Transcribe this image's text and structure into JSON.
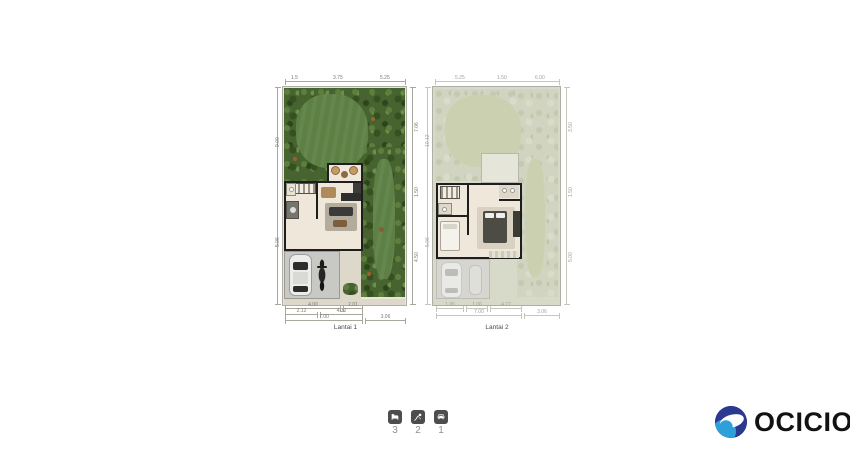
{
  "plans": [
    {
      "id": "lantai-1",
      "label": "Lantai 1",
      "dims": {
        "top": [
          "1.5",
          "3.75",
          "5.25"
        ],
        "left": [
          "9.00",
          "5.06"
        ],
        "right": [
          "7.06",
          "1.50",
          "4.50"
        ],
        "bottom_row1": [
          "4.00",
          "2.01"
        ],
        "bottom_row2": [
          "2.12",
          "4.32"
        ],
        "bottom_row3": [
          "7.00",
          "3.06"
        ]
      }
    },
    {
      "id": "lantai-2",
      "label": "Lantai 2",
      "dims": {
        "top": [
          "5.25",
          "1.50",
          "6.00"
        ],
        "left": [
          "10.12",
          "5.06"
        ],
        "right": [
          "3.50",
          "1.50",
          "5.00"
        ],
        "bottom_row1": [
          "1.95",
          "1.06",
          "4.77"
        ],
        "bottom_row2": [
          "7.00",
          "3.06"
        ]
      }
    }
  ],
  "features": [
    {
      "name": "bedrooms",
      "icon": "bed-icon",
      "count": "3"
    },
    {
      "name": "bathrooms",
      "icon": "shower-icon",
      "count": "2"
    },
    {
      "name": "carport",
      "icon": "car-icon",
      "count": "1"
    }
  ],
  "logo": {
    "text": "OCICIO",
    "mark_dark": "#2b3990",
    "mark_light": "#2e9fd8",
    "text_color": "#121212"
  },
  "palette": {
    "shrub": "#47632f",
    "lawn": "#5d8045",
    "faded_shrub": "#d0d4c0",
    "faded_lawn": "#cbd1b0",
    "floor": "#efe8da",
    "wall": "#1e1e1e",
    "carport": "#c8c8c4"
  }
}
